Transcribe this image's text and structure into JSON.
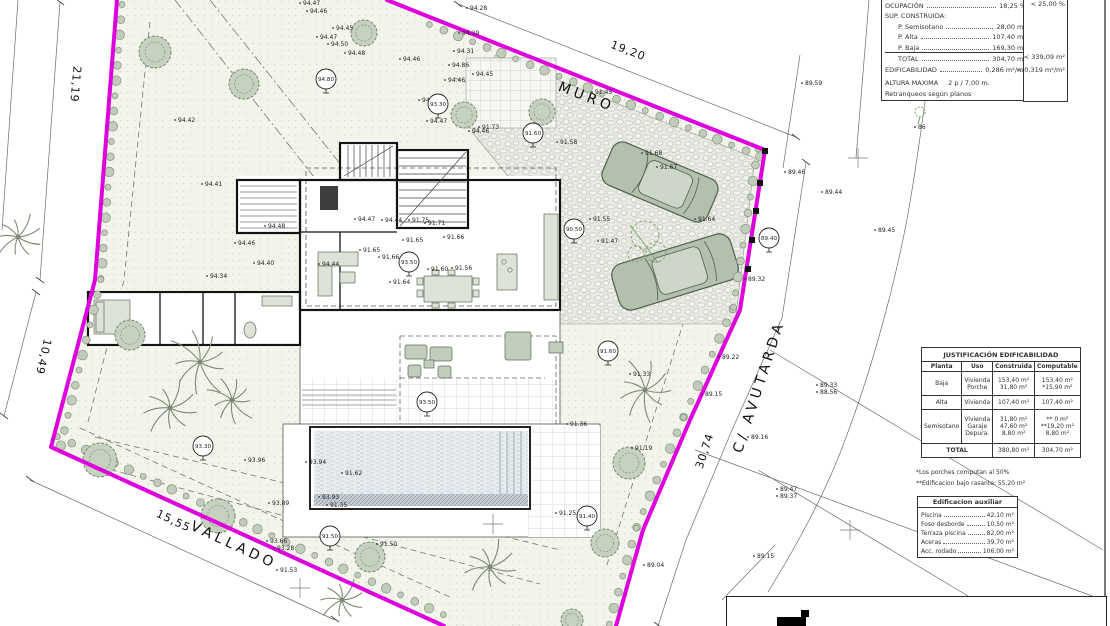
{
  "panel": {
    "rows": [
      {
        "label": "OCUPACIÓN",
        "value": "18,25 %",
        "limit": "< 25,00 %"
      },
      {
        "label": "SUP. CONSTRUIDA:",
        "value": "",
        "limit": ""
      },
      {
        "label": "P. Semisotano",
        "value": "28,00 m²",
        "limit": ""
      },
      {
        "label": "P. Alta",
        "value": "107,40 m²",
        "limit": ""
      },
      {
        "label": "P. Baja",
        "value": "169,30 m²",
        "limit": ""
      },
      {
        "label": "TOTAL",
        "value": "304,70 m²",
        "limit": "< 339,09 m²"
      },
      {
        "label": "EDIFICABILIDAD",
        "value": "0,286 m²/m²",
        "limit": "< 0,319 m²/m²"
      },
      {
        "label": "ALTURA MAXIMA",
        "value": "2 p / 7,00 m.",
        "limit": ""
      },
      {
        "label": "Retranqueos según planos",
        "value": "",
        "limit": ""
      }
    ]
  },
  "justificacion": {
    "title": "JUSTIFICACIÓN EDIFICABILIDAD",
    "headers": [
      "Planta",
      "Uso",
      "Construida",
      "Computable"
    ],
    "rows": [
      {
        "planta": "Baja",
        "usos": [
          "Vivienda",
          "Porche"
        ],
        "construida": [
          "153,40 m²",
          "31,80 m²"
        ],
        "computable": [
          "153,40 m²",
          "*15,90 m²"
        ]
      },
      {
        "planta": "Alta",
        "usos": [
          "Vivienda"
        ],
        "construida": [
          "107,40 m²"
        ],
        "computable": [
          "107,40 m²"
        ]
      },
      {
        "planta": "Semisotano",
        "usos": [
          "Vivienda",
          "Garaje",
          "Depura."
        ],
        "construida": [
          "31,80 m²",
          "47,60 m²",
          "8,80 m²"
        ],
        "computable": [
          "** 0 m²",
          "**19,20 m²",
          "8,80 m²"
        ]
      }
    ],
    "total": {
      "label": "TOTAL",
      "construida": "380,80 m²",
      "computable": "304,70 m²"
    },
    "notes": [
      "*Los porches computan al 50%",
      "**Edificacion bajo rasante: 55,20 m²"
    ]
  },
  "auxiliar": {
    "title": "Edificacion auxiliar",
    "rows": [
      {
        "label": "Piscina",
        "value": "42,10 m²"
      },
      {
        "label": "Foso desborde",
        "value": "10,50 m²"
      },
      {
        "label": "Terraza piscina",
        "value": "82,00 m²"
      },
      {
        "label": "Aceras",
        "value": "39,70 m²"
      },
      {
        "label": "Acc. rodado",
        "value": "106,00 m²"
      }
    ]
  },
  "plan": {
    "colors": {
      "boundary": "#dd00dd",
      "plot_fill": "#f3f5ec",
      "tree": "#c7d1c0",
      "car": "#b4c0ae"
    },
    "labels": [
      {
        "t": "MURO",
        "x": 585,
        "y": 101,
        "rot": 21,
        "cls": "street-t"
      },
      {
        "t": "C/ AVUTARDA",
        "x": 763,
        "y": 388,
        "rot": -72,
        "cls": "street-t"
      },
      {
        "t": "VALLADO",
        "x": 232,
        "y": 549,
        "rot": 25,
        "cls": "street-t"
      },
      {
        "t": "19,20",
        "x": 627,
        "y": 54,
        "rot": 21,
        "cls": "dim-t"
      },
      {
        "t": "21,19",
        "x": 72,
        "y": 84,
        "rot": 95,
        "cls": "dim-t"
      },
      {
        "t": "10,49",
        "x": 40,
        "y": 356,
        "rot": 103,
        "cls": "dim-t"
      },
      {
        "t": "15,55",
        "x": 172,
        "y": 524,
        "rot": 25,
        "cls": "dim-t"
      },
      {
        "t": "30,74",
        "x": 708,
        "y": 452,
        "rot": -72,
        "cls": "dim-t"
      }
    ],
    "benchmarks": [
      {
        "x": 326,
        "y": 79,
        "t": "94.80"
      },
      {
        "x": 438,
        "y": 104,
        "t": "93.30"
      },
      {
        "x": 533,
        "y": 133,
        "t": "91.60"
      },
      {
        "x": 574,
        "y": 229,
        "t": "90.50"
      },
      {
        "x": 769,
        "y": 238,
        "t": "89.40"
      },
      {
        "x": 409,
        "y": 262,
        "t": "93.50"
      },
      {
        "x": 608,
        "y": 351,
        "t": "91.60"
      },
      {
        "x": 427,
        "y": 402,
        "t": "93.50"
      },
      {
        "x": 203,
        "y": 446,
        "t": "93.30"
      },
      {
        "x": 330,
        "y": 536,
        "t": "91.50"
      },
      {
        "x": 587,
        "y": 516,
        "t": "91.40"
      }
    ],
    "spots": [
      {
        "x": 303,
        "y": 5,
        "t": "94.47"
      },
      {
        "x": 310,
        "y": 13,
        "t": "94.46"
      },
      {
        "x": 336,
        "y": 30,
        "t": "94.45"
      },
      {
        "x": 320,
        "y": 39,
        "t": "94.47"
      },
      {
        "x": 331,
        "y": 46,
        "t": "94.50"
      },
      {
        "x": 348,
        "y": 55,
        "t": "94.48"
      },
      {
        "x": 403,
        "y": 61,
        "t": "94.46"
      },
      {
        "x": 457,
        "y": 53,
        "t": "94.31"
      },
      {
        "x": 470,
        "y": 10,
        "t": "94.28"
      },
      {
        "x": 462,
        "y": 35,
        "t": "94.29"
      },
      {
        "x": 452,
        "y": 67,
        "t": "94.86"
      },
      {
        "x": 448,
        "y": 82,
        "t": "94.46"
      },
      {
        "x": 476,
        "y": 76,
        "t": "94.45"
      },
      {
        "x": 422,
        "y": 102,
        "t": "94.47"
      },
      {
        "x": 430,
        "y": 123,
        "t": "94.47"
      },
      {
        "x": 178,
        "y": 122,
        "t": "94.42"
      },
      {
        "x": 595,
        "y": 94,
        "t": "91.45"
      },
      {
        "x": 482,
        "y": 129,
        "t": "91.73"
      },
      {
        "x": 472,
        "y": 133,
        "t": "94.46"
      },
      {
        "x": 560,
        "y": 144,
        "t": "91.58"
      },
      {
        "x": 645,
        "y": 155,
        "t": "91.68"
      },
      {
        "x": 660,
        "y": 169,
        "t": "91.67"
      },
      {
        "x": 593,
        "y": 221,
        "t": "91.55"
      },
      {
        "x": 698,
        "y": 221,
        "t": "91.64"
      },
      {
        "x": 601,
        "y": 243,
        "t": "91.47"
      },
      {
        "x": 748,
        "y": 281,
        "t": "89.32"
      },
      {
        "x": 205,
        "y": 186,
        "t": "94.41"
      },
      {
        "x": 268,
        "y": 228,
        "t": "94.48"
      },
      {
        "x": 238,
        "y": 245,
        "t": "94.46"
      },
      {
        "x": 257,
        "y": 265,
        "t": "94.40"
      },
      {
        "x": 210,
        "y": 278,
        "t": "94.34"
      },
      {
        "x": 322,
        "y": 266,
        "t": "94.44"
      },
      {
        "x": 358,
        "y": 221,
        "t": "94.47"
      },
      {
        "x": 385,
        "y": 222,
        "t": "94.44"
      },
      {
        "x": 412,
        "y": 222,
        "t": "91.75"
      },
      {
        "x": 428,
        "y": 225,
        "t": "91.71"
      },
      {
        "x": 406,
        "y": 242,
        "t": "91.65"
      },
      {
        "x": 447,
        "y": 239,
        "t": "91.66"
      },
      {
        "x": 363,
        "y": 252,
        "t": "91.65"
      },
      {
        "x": 382,
        "y": 259,
        "t": "91.66"
      },
      {
        "x": 431,
        "y": 271,
        "t": "91.60"
      },
      {
        "x": 455,
        "y": 270,
        "t": "91.56"
      },
      {
        "x": 393,
        "y": 284,
        "t": "91.64"
      },
      {
        "x": 570,
        "y": 426,
        "t": "91.36"
      },
      {
        "x": 633,
        "y": 376,
        "t": "91.33"
      },
      {
        "x": 635,
        "y": 450,
        "t": "91.19"
      },
      {
        "x": 248,
        "y": 462,
        "t": "93.96"
      },
      {
        "x": 309,
        "y": 464,
        "t": "93.94"
      },
      {
        "x": 345,
        "y": 475,
        "t": "91.62"
      },
      {
        "x": 322,
        "y": 499,
        "t": "93.93"
      },
      {
        "x": 330,
        "y": 507,
        "t": "91.35"
      },
      {
        "x": 272,
        "y": 505,
        "t": "93.89"
      },
      {
        "x": 270,
        "y": 543,
        "t": "93.66"
      },
      {
        "x": 277,
        "y": 550,
        "t": "93.28"
      },
      {
        "x": 280,
        "y": 572,
        "t": "91.53"
      },
      {
        "x": 380,
        "y": 546,
        "t": "91.50"
      },
      {
        "x": 559,
        "y": 515,
        "t": "91.25"
      },
      {
        "x": 805,
        "y": 85,
        "t": "89.59"
      },
      {
        "x": 788,
        "y": 174,
        "t": "89.46"
      },
      {
        "x": 825,
        "y": 194,
        "t": "89.44"
      },
      {
        "x": 878,
        "y": 232,
        "t": "89.45"
      },
      {
        "x": 918,
        "y": 129,
        "t": "86"
      },
      {
        "x": 722,
        "y": 359,
        "t": "89.22"
      },
      {
        "x": 820,
        "y": 387,
        "t": "89.33"
      },
      {
        "x": 820,
        "y": 394,
        "t": "88.56"
      },
      {
        "x": 705,
        "y": 396,
        "t": "89.15"
      },
      {
        "x": 751,
        "y": 439,
        "t": "89.16"
      },
      {
        "x": 780,
        "y": 491,
        "t": "89.47"
      },
      {
        "x": 780,
        "y": 498,
        "t": "89.37"
      },
      {
        "x": 757,
        "y": 558,
        "t": "89.15"
      },
      {
        "x": 647,
        "y": 567,
        "t": "89.04"
      }
    ],
    "trees_round": [
      {
        "x": 155,
        "y": 52,
        "r": 16
      },
      {
        "x": 244,
        "y": 84,
        "r": 15
      },
      {
        "x": 364,
        "y": 33,
        "r": 13
      },
      {
        "x": 464,
        "y": 115,
        "r": 13
      },
      {
        "x": 542,
        "y": 112,
        "r": 13
      },
      {
        "x": 130,
        "y": 335,
        "r": 15
      },
      {
        "x": 100,
        "y": 460,
        "r": 17
      },
      {
        "x": 218,
        "y": 516,
        "r": 17
      },
      {
        "x": 370,
        "y": 557,
        "r": 15
      },
      {
        "x": 605,
        "y": 543,
        "r": 14
      },
      {
        "x": 629,
        "y": 463,
        "r": 16
      },
      {
        "x": 572,
        "y": 620,
        "r": 11
      }
    ],
    "palms": [
      {
        "x": 200,
        "y": 362,
        "r": 36
      },
      {
        "x": 170,
        "y": 408,
        "r": 30
      },
      {
        "x": 232,
        "y": 400,
        "r": 27
      },
      {
        "x": 645,
        "y": 390,
        "r": 33
      },
      {
        "x": 490,
        "y": 567,
        "r": 29
      },
      {
        "x": 342,
        "y": 600,
        "r": 24
      },
      {
        "x": 18,
        "y": 237,
        "r": 26
      }
    ],
    "hedges": [
      {
        "x1": 115,
        "y1": 4,
        "x2": 94,
        "y2": 278,
        "ox": 7,
        "oy": 0.5,
        "n": 19
      },
      {
        "x1": 94,
        "y1": 278,
        "x2": 54,
        "y2": 444,
        "ox": 6.8,
        "oy": 1.6,
        "n": 12
      },
      {
        "x1": 54,
        "y1": 444,
        "x2": 440,
        "y2": 622,
        "ox": 3.4,
        "oy": -7.3,
        "n": 28
      },
      {
        "x1": 432,
        "y1": 18,
        "x2": 763,
        "y2": 150,
        "ox": -2.6,
        "oy": 6.5,
        "n": 24
      },
      {
        "x1": 765,
        "y1": 150,
        "x2": 740,
        "y2": 310,
        "ox": -7,
        "oy": -1,
        "n": 11
      },
      {
        "x1": 740,
        "y1": 310,
        "x2": 690,
        "y2": 420,
        "ox": -6.4,
        "oy": -2.9,
        "n": 8
      },
      {
        "x1": 690,
        "y1": 420,
        "x2": 643,
        "y2": 530,
        "ox": -6.4,
        "oy": -2.8,
        "n": 8
      },
      {
        "x1": 643,
        "y1": 530,
        "x2": 616,
        "y2": 626,
        "ox": -6.7,
        "oy": -1.9,
        "n": 7
      }
    ],
    "crosses": [
      {
        "x": 858,
        "y": 158
      },
      {
        "x": 300,
        "y": 588
      },
      {
        "x": 493,
        "y": 524
      },
      {
        "x": 850,
        "y": 530
      }
    ],
    "posts": [
      {
        "x": 760,
        "y": 183
      },
      {
        "x": 756,
        "y": 211
      },
      {
        "x": 752,
        "y": 240
      },
      {
        "x": 748,
        "y": 269
      },
      {
        "x": 765,
        "y": 151
      }
    ]
  }
}
